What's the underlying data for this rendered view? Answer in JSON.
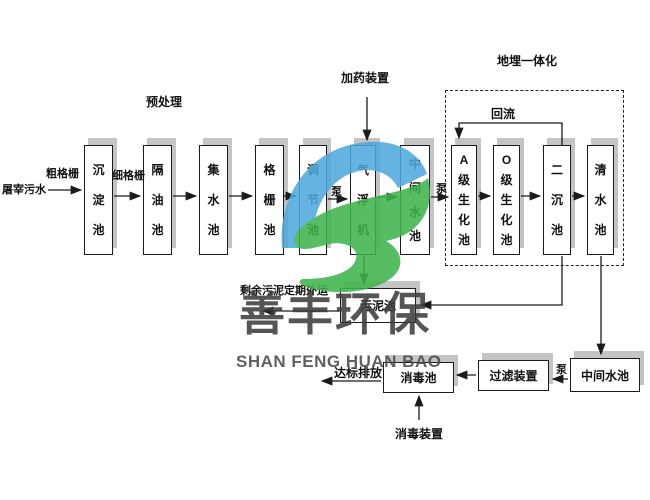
{
  "source": {
    "label": "屠宰污水"
  },
  "annotations": {
    "coarse_screen": "粗格栅",
    "fine_screen": "细格栅",
    "pretreatment": "预处理",
    "dosing_device": "加药装置",
    "buried_integrated": "地埋一体化",
    "reflux": "回流",
    "pump1": "泵",
    "pump2": "泵",
    "pump3": "泵",
    "sludge_out_note": "剩余污泥定期外运",
    "discharge": "达标排放",
    "disinfection_device": "消毒装置"
  },
  "tanks": [
    {
      "label": "沉淀池"
    },
    {
      "label": "隔油池"
    },
    {
      "label": "集水池"
    },
    {
      "label": "格栅池"
    },
    {
      "label": "调节池"
    },
    {
      "label": "气浮机"
    },
    {
      "label": "中间水池"
    },
    {
      "label": "A级生化池"
    },
    {
      "label": "O级生化池"
    },
    {
      "label": "二沉池"
    },
    {
      "label": "清水池"
    }
  ],
  "bottom_tanks": [
    {
      "label": "污泥池"
    },
    {
      "label": "消毒池"
    },
    {
      "label": "过滤装置"
    },
    {
      "label": "中间水池"
    }
  ],
  "watermark": {
    "cn": "善丰环保",
    "en": "SHAN FENG HUAN BAO",
    "blue": "#4FA8DC",
    "green": "#3EB44C",
    "text_color": "#3C3C3C"
  }
}
